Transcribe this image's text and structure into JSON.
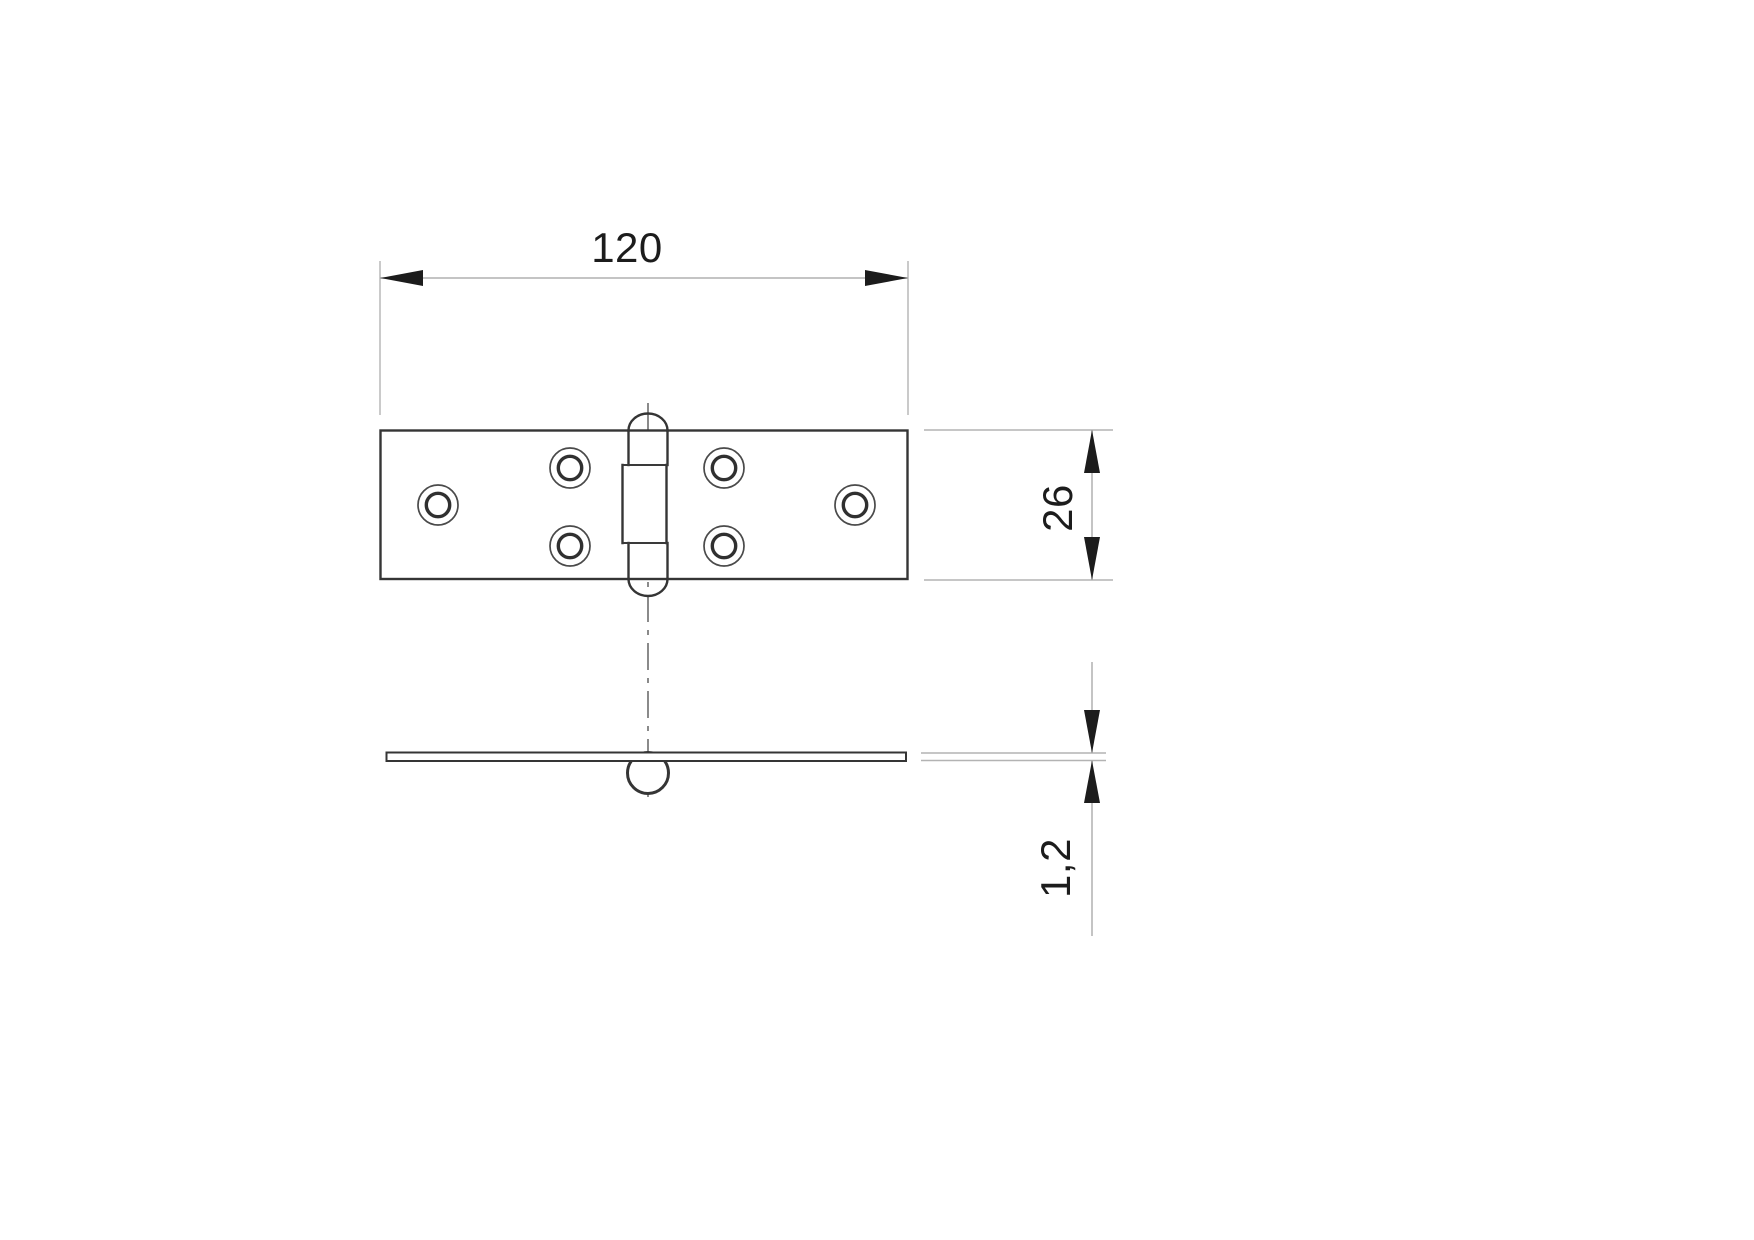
{
  "drawing": {
    "dimensions": {
      "width": {
        "label": "120"
      },
      "height": {
        "label": "26"
      },
      "thickness": {
        "label": "1,2"
      }
    },
    "part": {
      "screw_hole_count": 6,
      "knuckle_segment_count": 3
    },
    "colors": {
      "background": "#ffffff",
      "part_outline": "#353535",
      "dimension_line": "#b0b0b0",
      "centerline": "#6e6e6e",
      "arrow_and_text": "#1c1c1c"
    }
  }
}
